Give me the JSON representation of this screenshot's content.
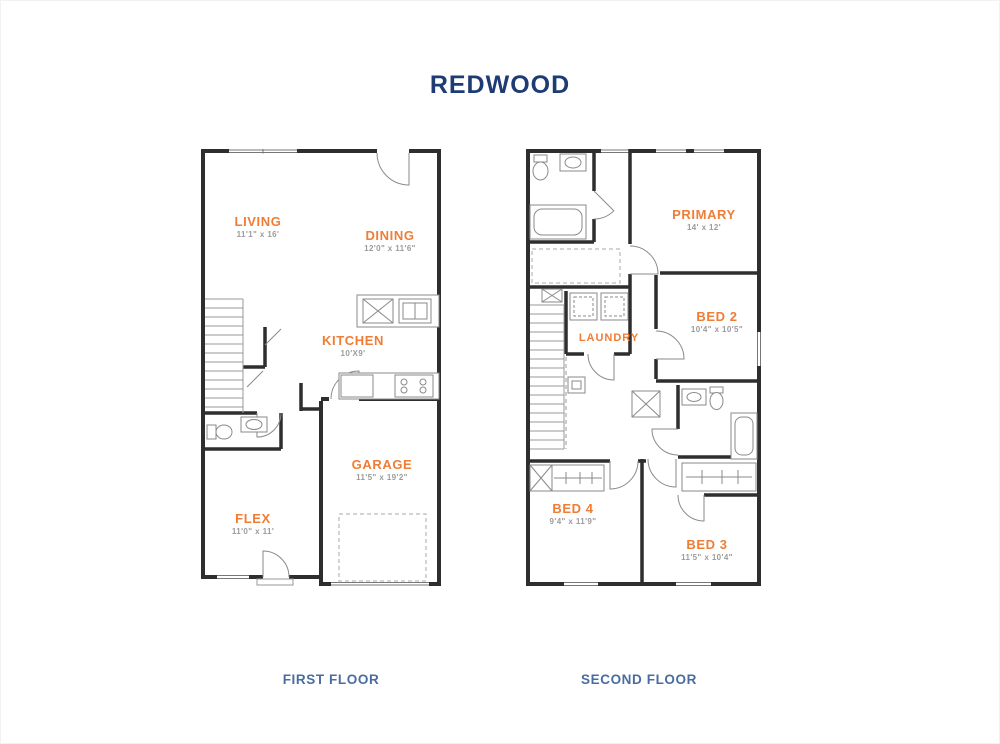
{
  "title": "REDWOOD",
  "colors": {
    "title_navy": "#1e3c74",
    "room_label_orange": "#ef7d35",
    "dimension_gray": "#9b9b9b",
    "caption_blue": "#4a6da0",
    "wall_black": "#2e2e2e"
  },
  "floors": [
    {
      "caption": "FIRST FLOOR",
      "rooms": [
        {
          "name": "LIVING",
          "dims": "11'1\" x 16'"
        },
        {
          "name": "DINING",
          "dims": "12'0\" x 11'6\""
        },
        {
          "name": "KITCHEN",
          "dims": "10'X9'"
        },
        {
          "name": "GARAGE",
          "dims": "11'5\" x 19'2\""
        },
        {
          "name": "FLEX",
          "dims": "11'0\" x 11'"
        }
      ],
      "fixtures": [
        "stairs",
        "powder-toilet",
        "powder-sink",
        "kitchen-island-sink",
        "dishwasher",
        "refrigerator",
        "stove",
        "garage-parking-pad",
        "entry-door",
        "rear-door"
      ]
    },
    {
      "caption": "SECOND FLOOR",
      "rooms": [
        {
          "name": "PRIMARY",
          "dims": "14' x 12'"
        },
        {
          "name": "BED 2",
          "dims": "10'4\" x 10'5\""
        },
        {
          "name": "LAUNDRY",
          "dims": ""
        },
        {
          "name": "BED 4",
          "dims": "9'4\" x 11'9\""
        },
        {
          "name": "BED 3",
          "dims": "11'5\" x 10'4\""
        }
      ],
      "fixtures": [
        "stairs",
        "primary-bath-toilet",
        "primary-bath-sink",
        "bathtub",
        "walk-in-closet",
        "washer",
        "dryer",
        "attic-access",
        "hall-bath-sink",
        "hall-bath-toilet",
        "hall-bath-tub",
        "bed4-closet",
        "bed3-closet"
      ]
    }
  ]
}
